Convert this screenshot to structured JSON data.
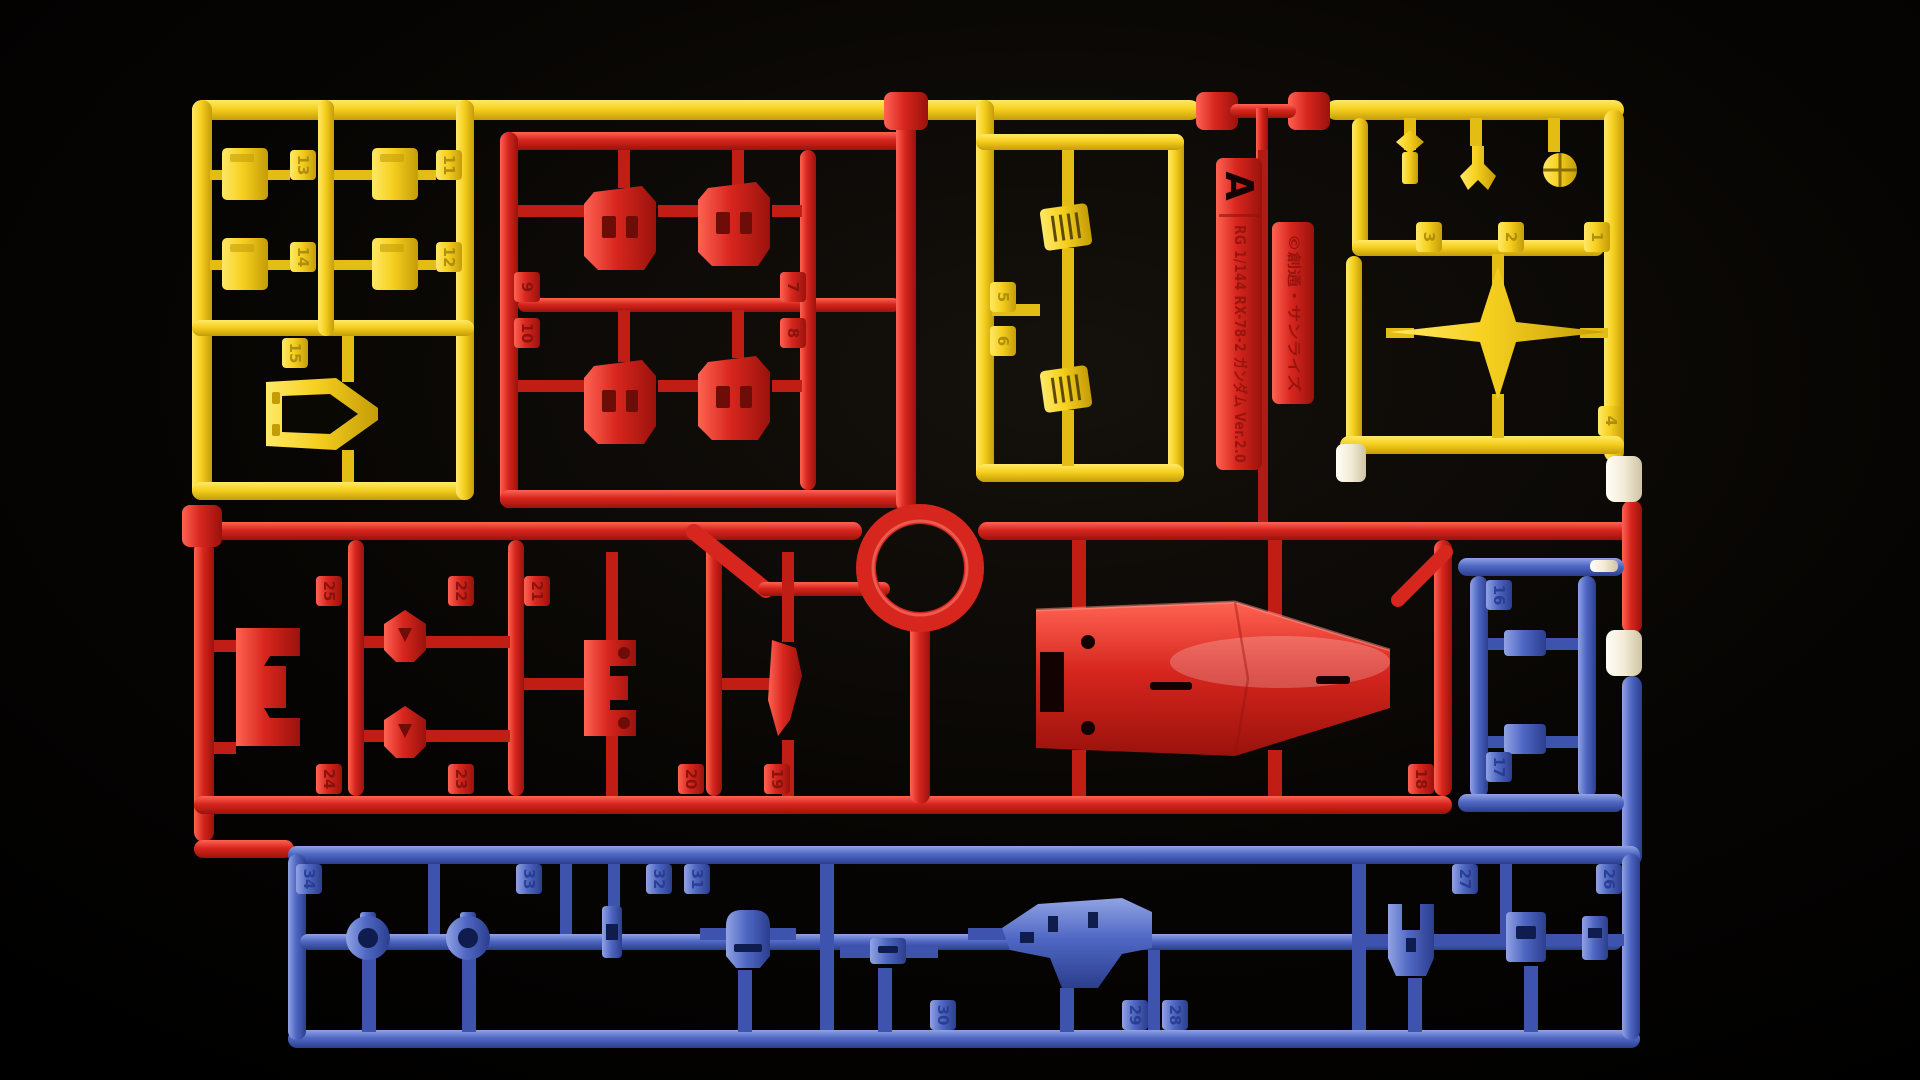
{
  "runner": {
    "letter": "A",
    "tag_title": "RG 1/144 RX-78-2 ガンダム Ver.2.0",
    "copyright": "©創通・サンライズ",
    "colors": {
      "yellow": "#f6d01f",
      "red": "#d7261e",
      "blue": "#5068c4",
      "cream": "#f3ebd6",
      "background": "#000000"
    },
    "parts": {
      "yellow": [
        "1",
        "2",
        "3",
        "4",
        "5",
        "6",
        "11",
        "12",
        "13",
        "14",
        "15"
      ],
      "red": [
        "7",
        "8",
        "9",
        "10",
        "18",
        "19",
        "20",
        "21",
        "22",
        "23",
        "24",
        "25"
      ],
      "blue": [
        "16",
        "17",
        "26",
        "27",
        "28",
        "29",
        "30",
        "31",
        "32",
        "33",
        "34"
      ]
    }
  }
}
